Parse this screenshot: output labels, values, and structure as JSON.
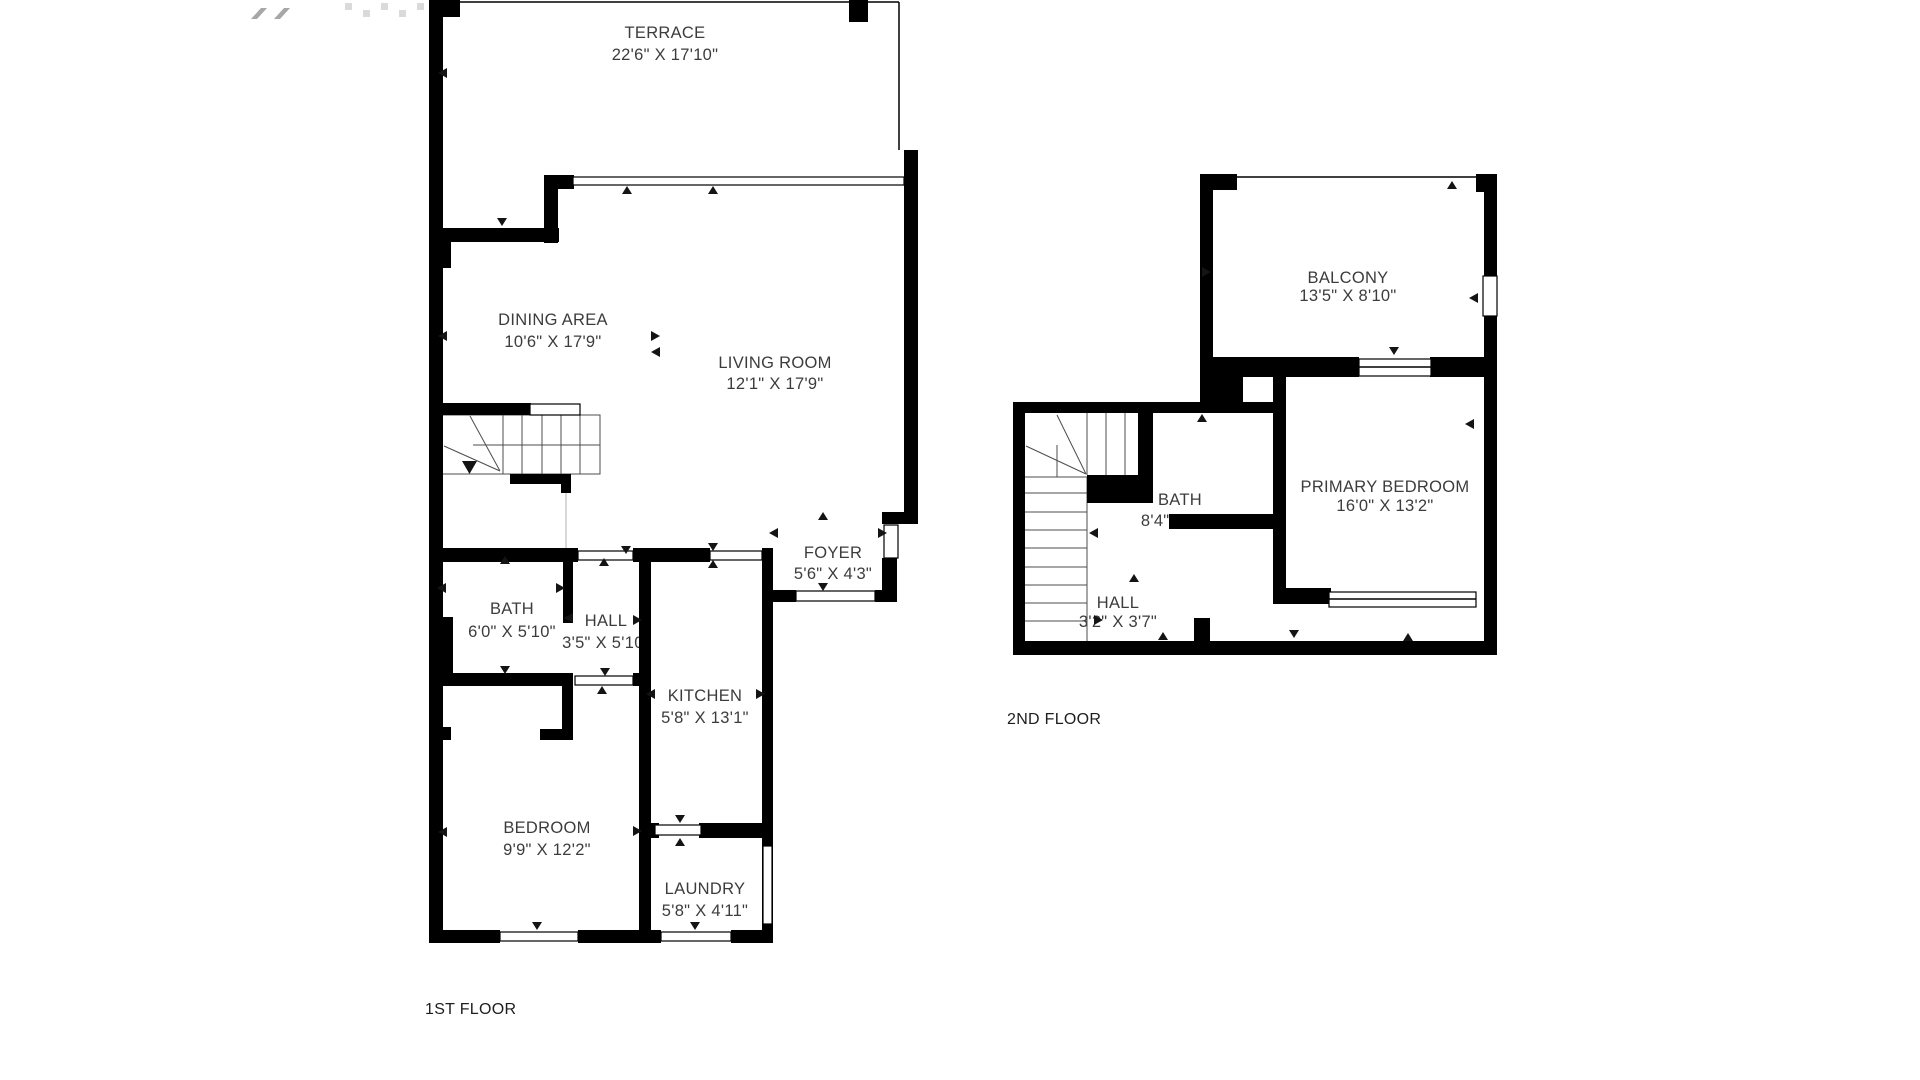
{
  "colors": {
    "wall": "#000000",
    "room_label": "#3c3c3c",
    "floor_label": "#1e1e1e",
    "stair_line": "#4d4d4d",
    "background": "#ffffff"
  },
  "floors": {
    "first": {
      "label": "1ST FLOOR",
      "rooms": {
        "terrace": {
          "name": "TERRACE",
          "dims": "22'6\" X 17'10\""
        },
        "dining": {
          "name": "DINING AREA",
          "dims": "10'6\" X 17'9\""
        },
        "living": {
          "name": "LIVING ROOM",
          "dims": "12'1\" X 17'9\""
        },
        "foyer": {
          "name": "FOYER",
          "dims": "5'6\" X 4'3\""
        },
        "bath": {
          "name": "BATH",
          "dims": "6'0\" X 5'10\""
        },
        "hall": {
          "name": "HALL",
          "dims": "3'5\" X 5'10\""
        },
        "kitchen": {
          "name": "KITCHEN",
          "dims": "5'8\" X 13'1\""
        },
        "bedroom": {
          "name": "BEDROOM",
          "dims": "9'9\" X 12'2\""
        },
        "laundry": {
          "name": "LAUNDRY",
          "dims": "5'8\" X 4'11\""
        }
      }
    },
    "second": {
      "label": "2ND FLOOR",
      "rooms": {
        "balcony": {
          "name": "BALCONY",
          "dims": "13'5\" X 8'10\""
        },
        "bath": {
          "name": "BATH",
          "dims": "8'4\" X 7'5\""
        },
        "primary_bedroom": {
          "name": "PRIMARY BEDROOM",
          "dims": "16'0\" X 13'2\""
        },
        "hall": {
          "name": "HALL",
          "dims": "3'2\" X 3'7\""
        }
      }
    }
  }
}
